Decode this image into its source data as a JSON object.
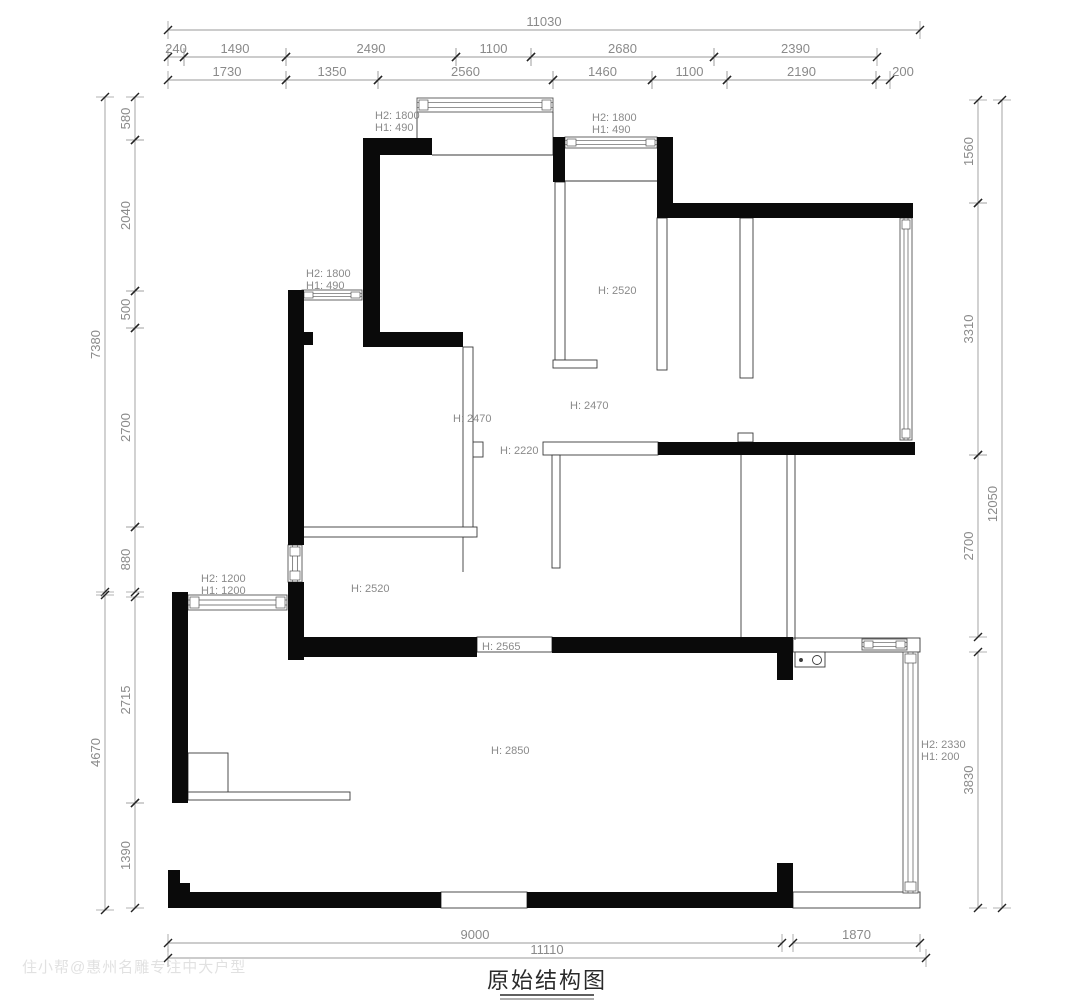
{
  "title": {
    "text": "原始结构图"
  },
  "watermark": "住小帮@惠州名雕专注中大户型",
  "colors": {
    "wall": "#0a0a0a",
    "thin_stroke": "#3a3a3a",
    "window_stroke": "#555555",
    "dim_line": "#9a9a9a",
    "dim_tick": "#222222",
    "dim_text": "#8a8a8a",
    "height_label": "#8a8a8a",
    "title": "#2a2a2a"
  },
  "plan": {
    "walls": [
      [
        363,
        138,
        69,
        17
      ],
      [
        363,
        138,
        17,
        209
      ],
      [
        553,
        137,
        12,
        45
      ],
      [
        657,
        137,
        16,
        81
      ],
      [
        657,
        203,
        256,
        15
      ],
      [
        288,
        290,
        16,
        255
      ],
      [
        288,
        582,
        16,
        78
      ],
      [
        298,
        332,
        15,
        13
      ],
      [
        380,
        332,
        83,
        15
      ],
      [
        658,
        442,
        257,
        13
      ],
      [
        290,
        637,
        187,
        20
      ],
      [
        552,
        637,
        241,
        16
      ],
      [
        777,
        653,
        16,
        27
      ],
      [
        172,
        592,
        16,
        211
      ],
      [
        168,
        870,
        12,
        22
      ],
      [
        180,
        883,
        10,
        9
      ],
      [
        168,
        892,
        273,
        16
      ],
      [
        527,
        892,
        266,
        16
      ],
      [
        777,
        863,
        16,
        45
      ]
    ],
    "outlines": [
      [
        543,
        442,
        115,
        13
      ],
      [
        477,
        637,
        75,
        15
      ],
      [
        441,
        892,
        86,
        16
      ],
      [
        793,
        638,
        127,
        14
      ],
      [
        793,
        892,
        127,
        16
      ],
      [
        738,
        433,
        15,
        9
      ],
      [
        465,
        442,
        18,
        15
      ],
      [
        795,
        652,
        30,
        15
      ],
      [
        555,
        182,
        10,
        178
      ],
      [
        553,
        360,
        44,
        8
      ],
      [
        657,
        218,
        10,
        152
      ],
      [
        740,
        218,
        13,
        160
      ],
      [
        463,
        347,
        10,
        190
      ],
      [
        303,
        527,
        174,
        10
      ],
      [
        552,
        455,
        8,
        113
      ],
      [
        188,
        753,
        40,
        40
      ],
      [
        188,
        792,
        162,
        8
      ]
    ],
    "lines": [
      [
        417,
        112,
        417,
        155
      ],
      [
        553,
        112,
        553,
        155
      ],
      [
        432,
        155,
        553,
        155
      ],
      [
        565,
        181,
        657,
        181
      ],
      [
        741,
        455,
        741,
        637
      ],
      [
        787,
        455,
        787,
        640
      ],
      [
        795,
        455,
        795,
        640
      ],
      [
        463,
        537,
        463,
        572
      ]
    ],
    "windows": [
      {
        "x": 417,
        "y": 98,
        "w": 136,
        "h": 14,
        "o": "h"
      },
      {
        "x": 565,
        "y": 137,
        "w": 92,
        "h": 11,
        "o": "h"
      },
      {
        "x": 302,
        "y": 290,
        "w": 60,
        "h": 10,
        "o": "h"
      },
      {
        "x": 288,
        "y": 545,
        "w": 14,
        "h": 37,
        "o": "v"
      },
      {
        "x": 188,
        "y": 595,
        "w": 99,
        "h": 15,
        "o": "h"
      },
      {
        "x": 900,
        "y": 218,
        "w": 12,
        "h": 222,
        "o": "v"
      },
      {
        "x": 903,
        "y": 652,
        "w": 15,
        "h": 241,
        "o": "v"
      },
      {
        "x": 862,
        "y": 639,
        "w": 45,
        "h": 11,
        "o": "h"
      }
    ],
    "circles": [
      {
        "cx": 817,
        "cy": 660,
        "r": 4.5,
        "filled": false
      },
      {
        "cx": 801,
        "cy": 660,
        "r": 1.5,
        "filled": true
      }
    ],
    "height_labels": [
      {
        "x": 375,
        "y": 119,
        "lines": [
          "H2: 1800",
          "H1: 490"
        ]
      },
      {
        "x": 592,
        "y": 121,
        "lines": [
          "H2: 1800",
          "H1: 490"
        ]
      },
      {
        "x": 306,
        "y": 277,
        "lines": [
          "H2: 1800",
          "H1: 490"
        ]
      },
      {
        "x": 598,
        "y": 294,
        "lines": [
          "H: 2520"
        ]
      },
      {
        "x": 570,
        "y": 409,
        "lines": [
          "H: 2470"
        ]
      },
      {
        "x": 453,
        "y": 422,
        "lines": [
          "H: 2470"
        ]
      },
      {
        "x": 500,
        "y": 454,
        "lines": [
          "H: 2220"
        ]
      },
      {
        "x": 201,
        "y": 582,
        "lines": [
          "H2: 1200",
          "H1: 1200"
        ]
      },
      {
        "x": 351,
        "y": 592,
        "lines": [
          "H: 2520"
        ]
      },
      {
        "x": 482,
        "y": 650,
        "lines": [
          "H: 2565"
        ]
      },
      {
        "x": 491,
        "y": 754,
        "lines": [
          "H: 2850"
        ]
      },
      {
        "x": 921,
        "y": 748,
        "lines": [
          "H2: 2330",
          "H1: 200"
        ]
      }
    ]
  },
  "dimensions": [
    {
      "axis": "h",
      "pos": 30,
      "segs": [
        {
          "t": "11030",
          "a": 168,
          "b": 920
        }
      ]
    },
    {
      "axis": "h",
      "pos": 57,
      "segs": [
        {
          "t": "240",
          "a": 168,
          "b": 184
        },
        {
          "t": "1490",
          "a": 184,
          "b": 286
        },
        {
          "t": "2490",
          "a": 286,
          "b": 456
        },
        {
          "t": "1100",
          "a": 456,
          "b": 531
        },
        {
          "t": "2680",
          "a": 531,
          "b": 714
        },
        {
          "t": "2390",
          "a": 714,
          "b": 877
        }
      ]
    },
    {
      "axis": "h",
      "pos": 80,
      "segs": [
        {
          "t": "1730",
          "a": 168,
          "b": 286
        },
        {
          "t": "1350",
          "a": 286,
          "b": 378
        },
        {
          "t": "2560",
          "a": 378,
          "b": 553
        },
        {
          "t": "1460",
          "a": 553,
          "b": 652
        },
        {
          "t": "1100",
          "a": 652,
          "b": 727
        },
        {
          "t": "2190",
          "a": 727,
          "b": 876
        },
        {
          "t": "200",
          "a": 876,
          "b": 890,
          "lx": 903
        }
      ]
    },
    {
      "axis": "v",
      "pos": 105,
      "segs": [
        {
          "t": "7380",
          "a": 97,
          "b": 592
        },
        {
          "t": "4670",
          "a": 595,
          "b": 910
        }
      ]
    },
    {
      "axis": "v",
      "pos": 135,
      "segs": [
        {
          "t": "580",
          "a": 97,
          "b": 140
        },
        {
          "t": "2040",
          "a": 140,
          "b": 291
        },
        {
          "t": "500",
          "a": 291,
          "b": 328
        },
        {
          "t": "2700",
          "a": 328,
          "b": 527
        },
        {
          "t": "880",
          "a": 527,
          "b": 592
        },
        {
          "t": "2715",
          "a": 597,
          "b": 803
        },
        {
          "t": "1390",
          "a": 803,
          "b": 908
        }
      ]
    },
    {
      "axis": "v",
      "pos": 978,
      "segs": [
        {
          "t": "1560",
          "a": 100,
          "b": 203
        },
        {
          "t": "3310",
          "a": 203,
          "b": 455
        },
        {
          "t": "2700",
          "a": 455,
          "b": 637
        },
        {
          "t": "3830",
          "a": 652,
          "b": 908
        }
      ]
    },
    {
      "axis": "v",
      "pos": 1002,
      "segs": [
        {
          "t": "12050",
          "a": 100,
          "b": 908
        }
      ]
    },
    {
      "axis": "h",
      "pos": 943,
      "segs": [
        {
          "t": "9000",
          "a": 168,
          "b": 782
        },
        {
          "t": "1870",
          "a": 793,
          "b": 920
        }
      ]
    },
    {
      "axis": "h",
      "pos": 958,
      "segs": [
        {
          "t": "11110",
          "a": 168,
          "b": 926
        }
      ]
    }
  ]
}
